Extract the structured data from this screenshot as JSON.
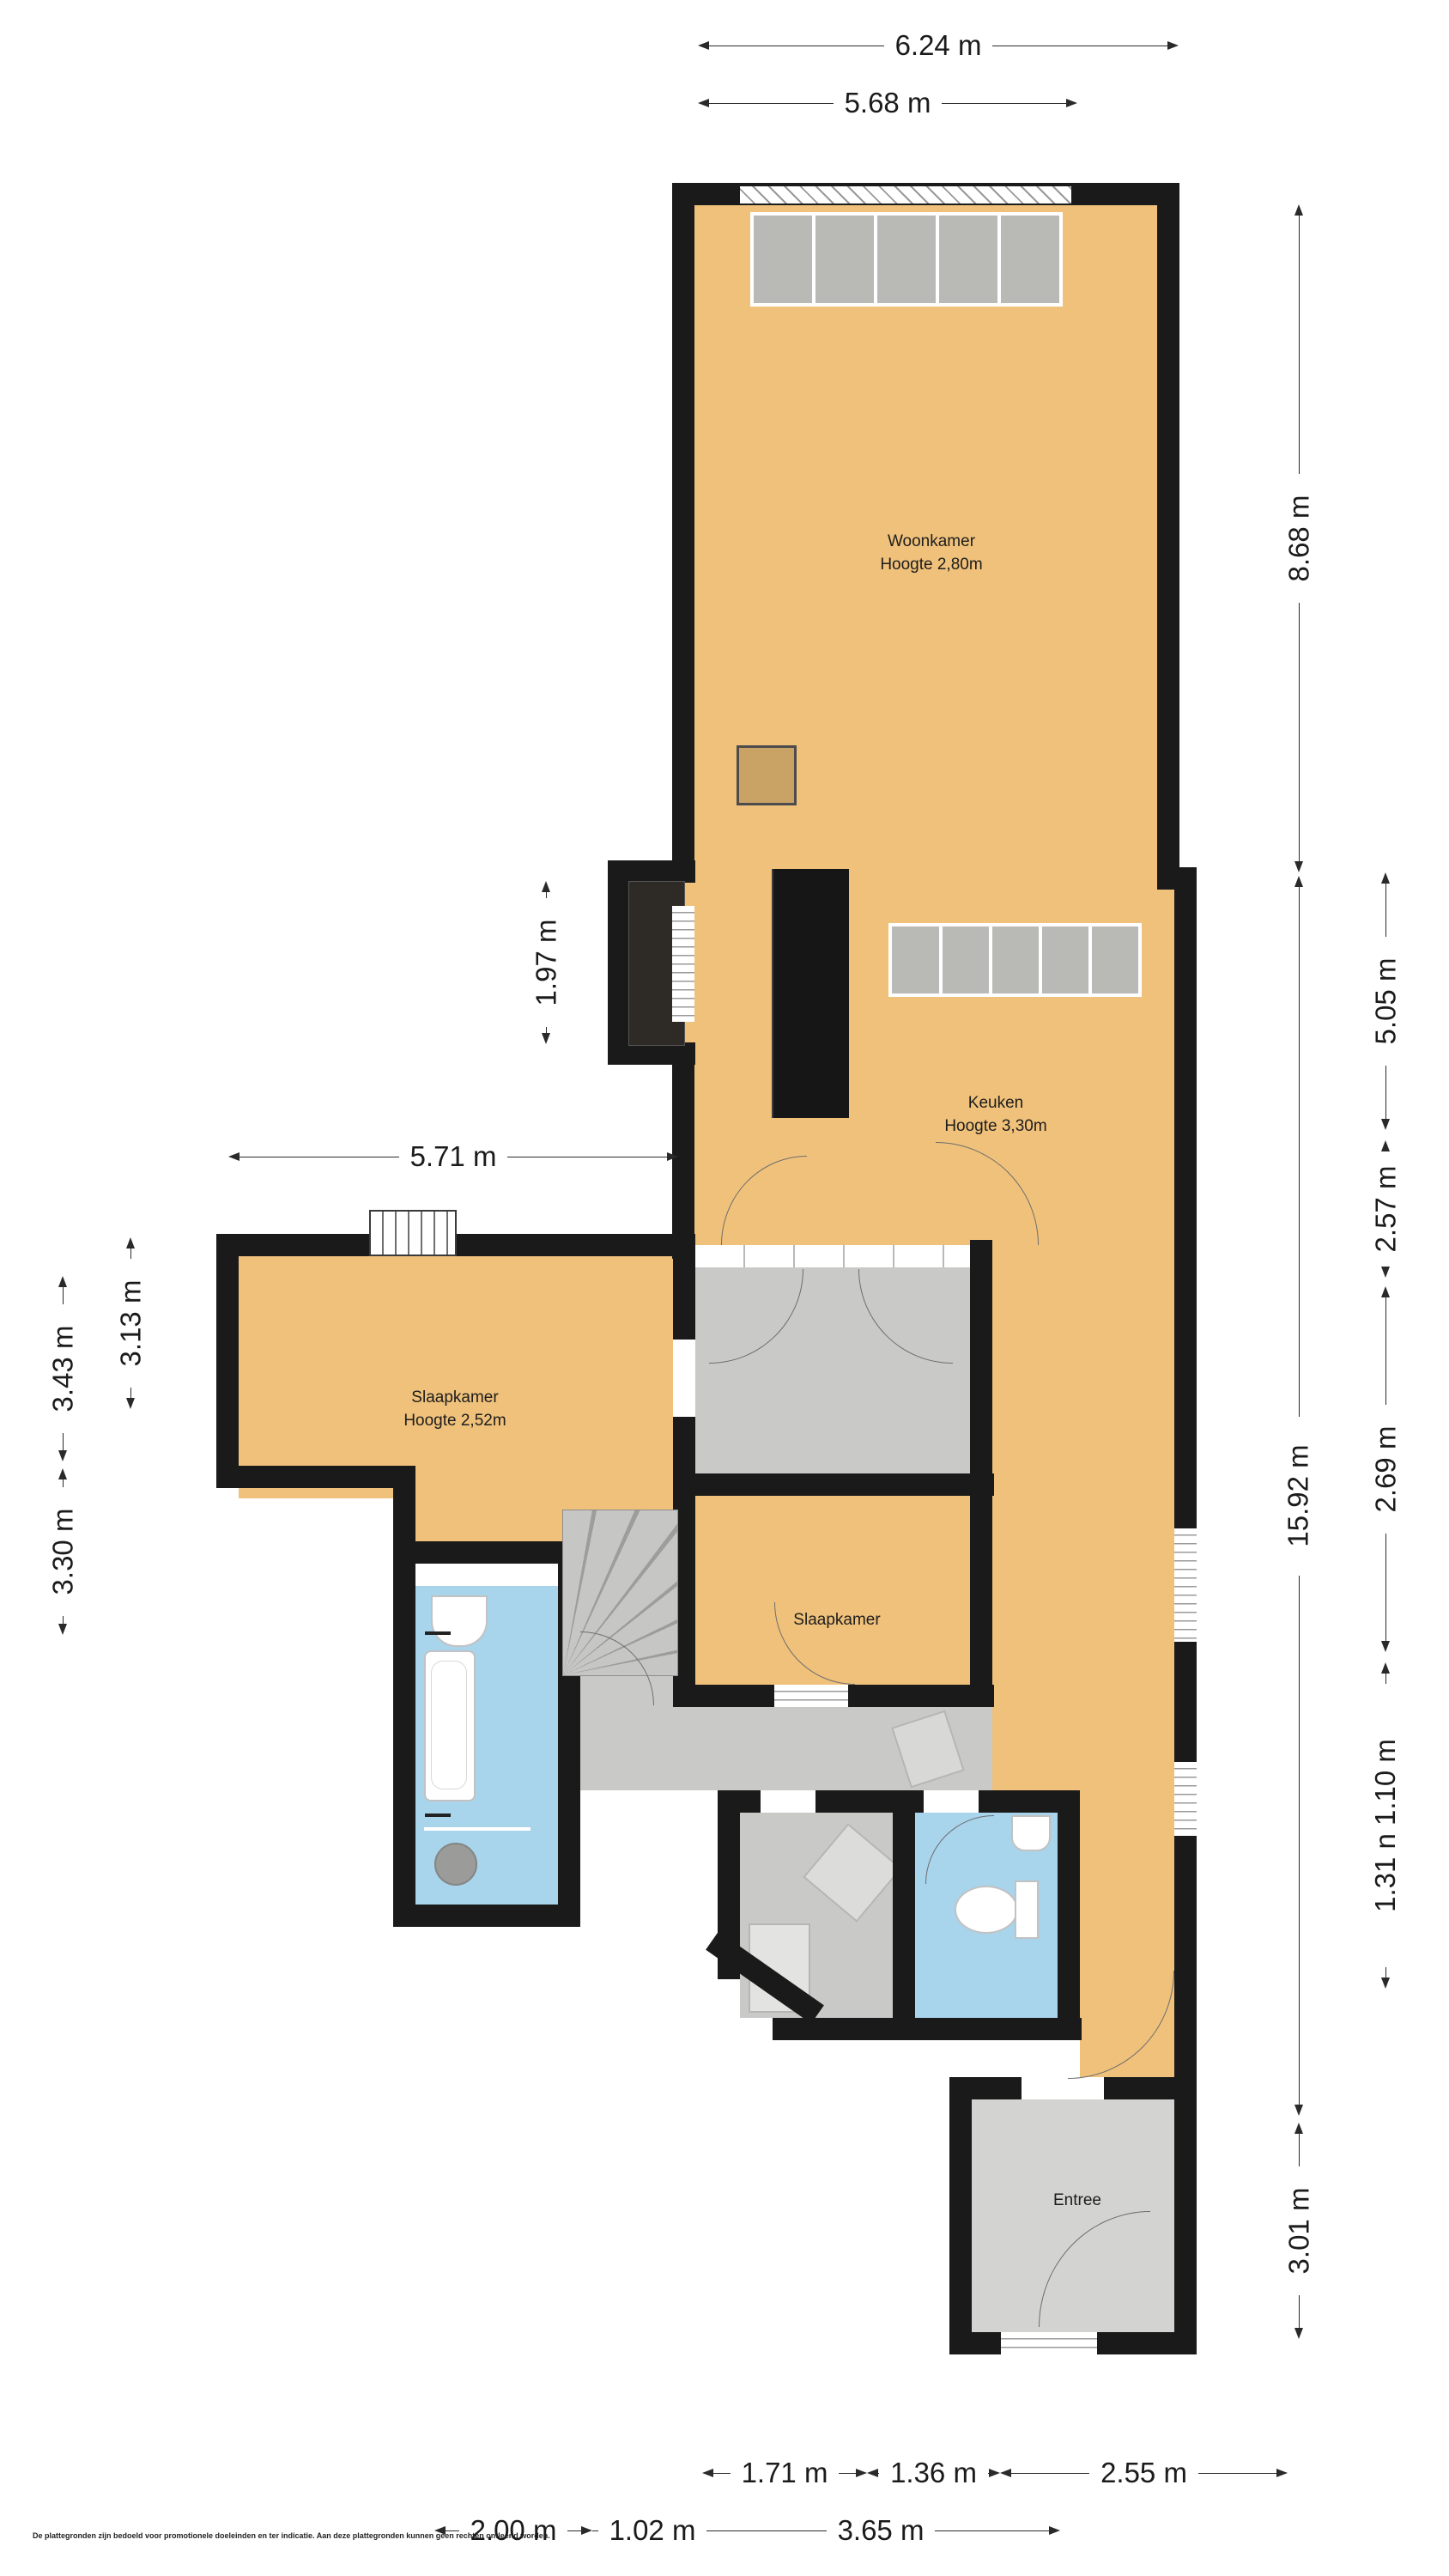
{
  "rooms": {
    "woonkamer": {
      "name": "Woonkamer",
      "height": "Hoogte 2,80m"
    },
    "keuken": {
      "name": "Keuken",
      "height": "Hoogte 3,30m"
    },
    "slaapkamer_1": {
      "name": "Slaapkamer",
      "height": "Hoogte 2,52m"
    },
    "slaapkamer_2": {
      "name": "Slaapkamer"
    },
    "entree": {
      "name": "Entree"
    }
  },
  "dimensions": {
    "top": [
      "6.24 m",
      "5.68 m"
    ],
    "right_inner": [
      "8.68 m",
      "15.92 m",
      "3.01 m"
    ],
    "right_outer": [
      "5.05 m",
      "2.57 m",
      "2.69 m",
      "1.31 n 1.10 m"
    ],
    "left_outer": [
      "3.43 m",
      "3.30 m"
    ],
    "left_inner": [
      "3.13 m"
    ],
    "middle": [
      "1.97 m",
      "5.71 m"
    ],
    "bottom_row_1": [
      "1.71 m",
      "1.36 m",
      "2.55 m"
    ],
    "bottom_row_2": [
      "2.00 m",
      "1.02 m",
      "3.65 m"
    ]
  },
  "disclaimer": "De plattegronden zijn bedoeld voor promotionele doeleinden en ter indicatie. Aan deze plattegronden kunnen geen rechten ontleend worden.",
  "colors": {
    "floor_orange": "#F0C17A",
    "floor_gray": "#C9C9C7",
    "floor_blue": "#A8D4EC",
    "wall": "#1A1A1A",
    "window_block": "#B9B9B5"
  }
}
